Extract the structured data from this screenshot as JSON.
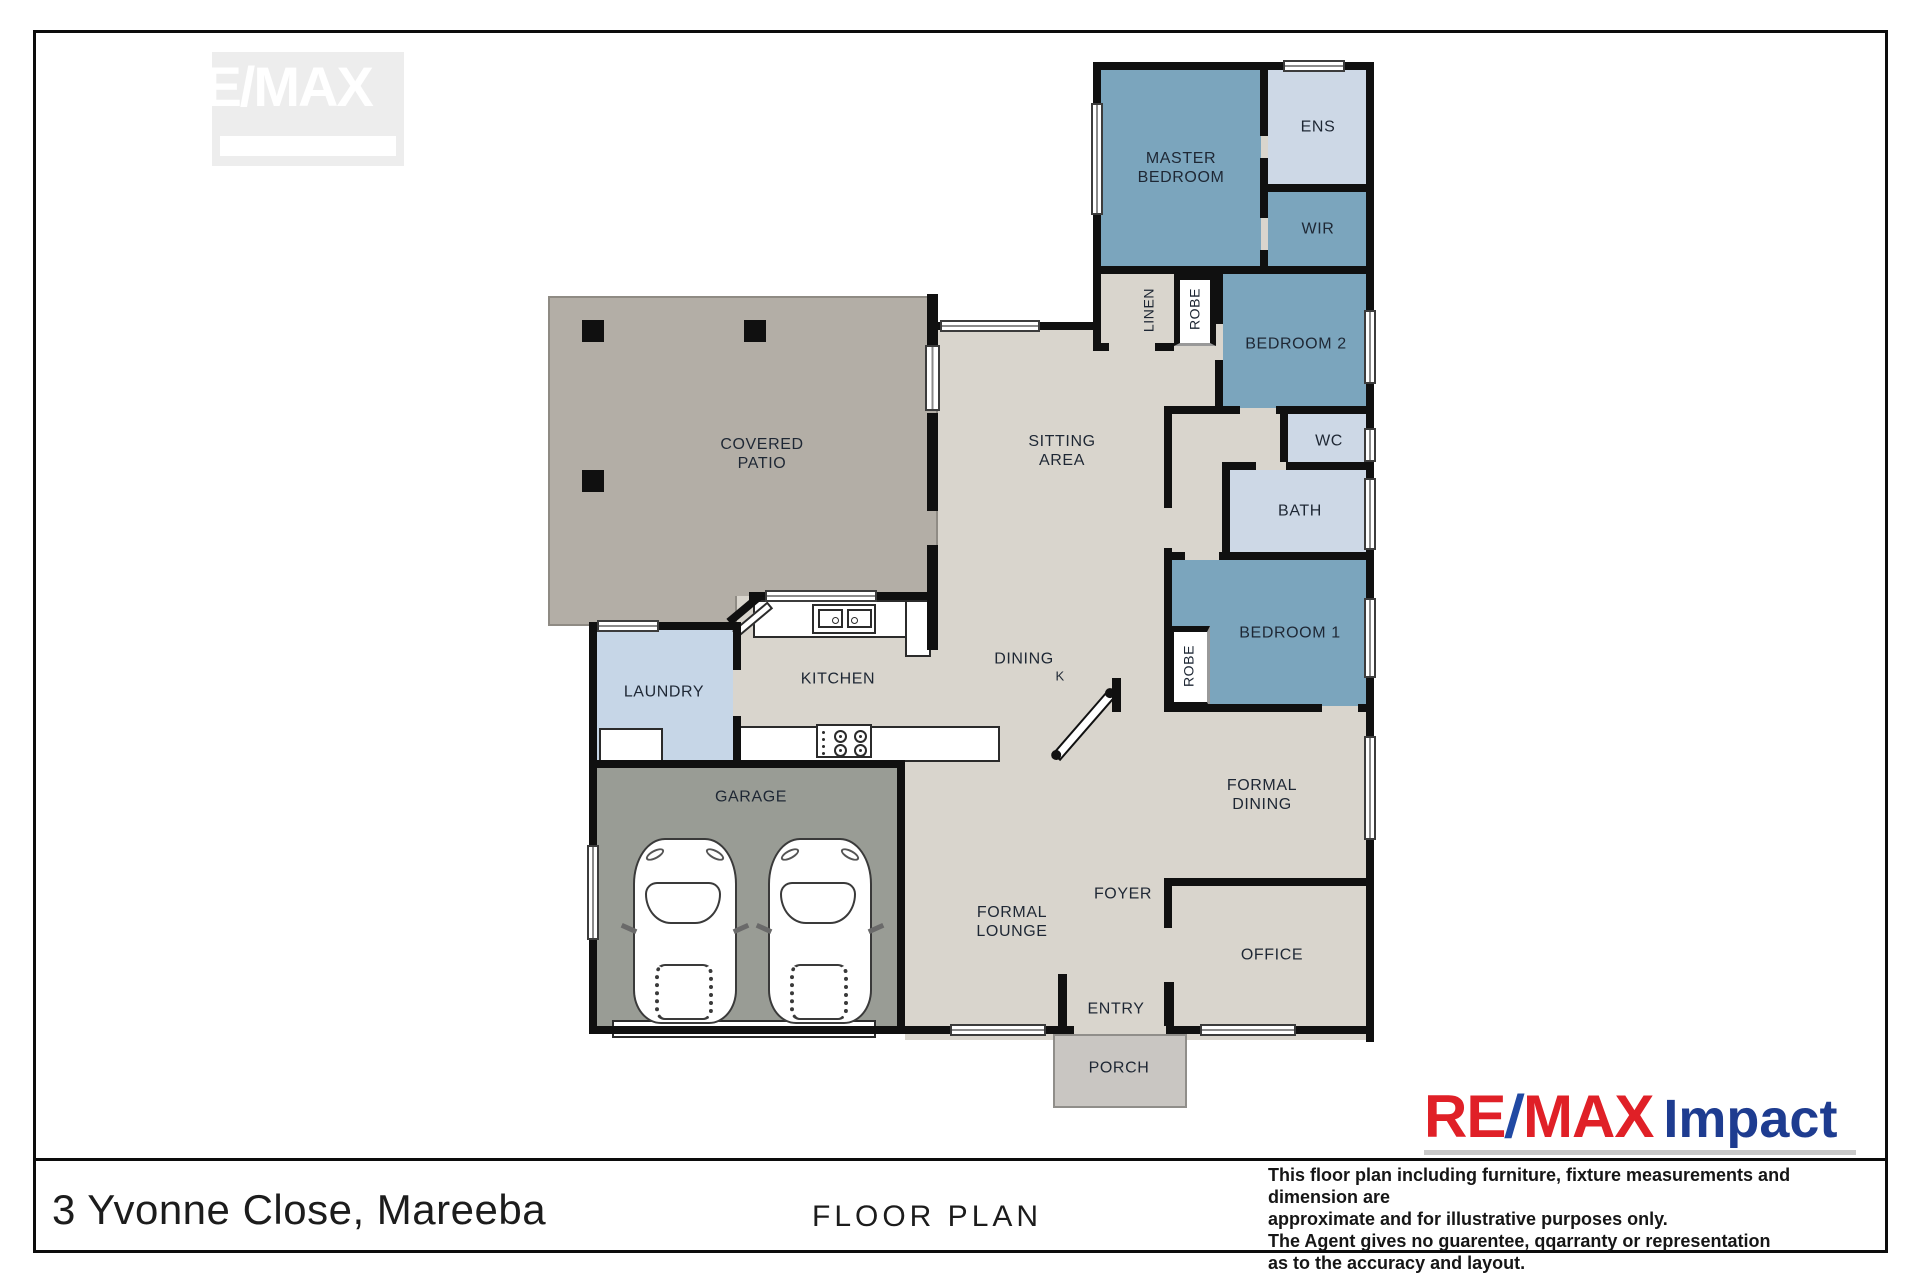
{
  "watermark": {
    "text": "RE/MAX"
  },
  "plan": {
    "rooms": {
      "master": "MASTER\nBEDROOM",
      "ens": "ENS",
      "wir": "WIR",
      "bedroom2": "BEDROOM 2",
      "wc": "WC",
      "bath": "BATH",
      "bedroom1": "BEDROOM 1",
      "robe_top": "ROBE",
      "robe_bottom": "ROBE",
      "linen": "LINEN",
      "sitting": "SITTING\nAREA",
      "patio": "COVERED\nPATIO",
      "laundry": "LAUNDRY",
      "kitchen": "KITCHEN",
      "dining": "DINING",
      "dining_k": "K",
      "formal_dining": "FORMAL\nDINING",
      "garage": "GARAGE",
      "formal_lounge": "FORMAL\nLOUNGE",
      "foyer": "FOYER",
      "office": "OFFICE",
      "entry": "ENTRY",
      "porch": "PORCH"
    },
    "colors": {
      "bedroom-blue": "#7ba5bd",
      "wet-area-blue": "#cdd8e6",
      "laundry-blue": "#c6d6e7",
      "floor-beige": "#d9d5cd",
      "patio-taupe": "#b3aea6",
      "garage-grey": "#999c95",
      "porch-grey": "#c9c6c2",
      "wall-black": "#101010",
      "logo-red": "#e02027",
      "logo-blue": "#2149a3",
      "logo-navy": "#1e3c90"
    }
  },
  "footer": {
    "address": "3 Yvonne Close, Mareeba",
    "plan_title": "FLOOR PLAN",
    "disclaimer": "This floor plan including furniture, fixture measurements and dimension are\napproximate and for illustrative purposes only.\nThe Agent gives no guarentee, qqarranty or representation\nas to the accuracy and layout."
  },
  "logo": {
    "part1": "RE",
    "slash": "/",
    "part2": "MAX",
    "word": "Impact"
  }
}
